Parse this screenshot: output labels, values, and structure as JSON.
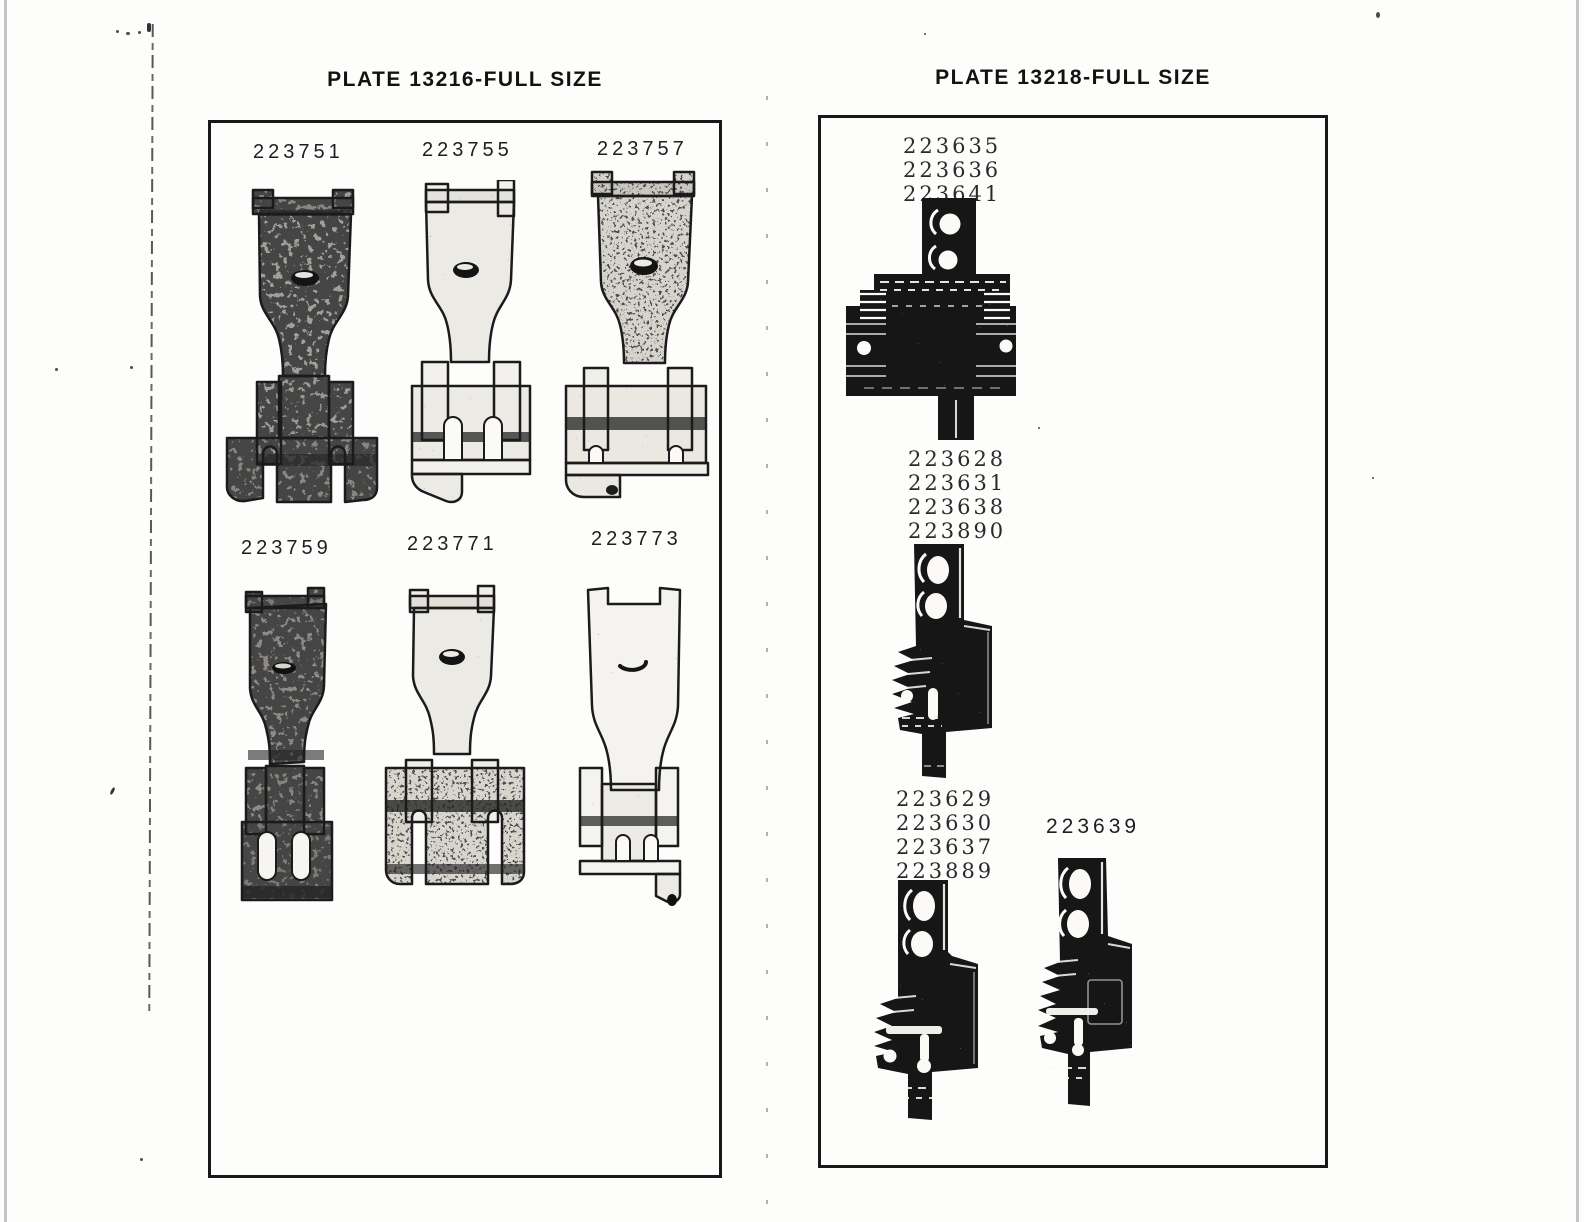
{
  "document": {
    "plates": [
      {
        "title": "PLATE 13216-FULL SIZE",
        "parts": [
          {
            "labels": [
              "223751"
            ]
          },
          {
            "labels": [
              "223755"
            ]
          },
          {
            "labels": [
              "223757"
            ]
          },
          {
            "labels": [
              "223759"
            ]
          },
          {
            "labels": [
              "223771"
            ]
          },
          {
            "labels": [
              "223773"
            ]
          }
        ]
      },
      {
        "title": "PLATE 13218-FULL SIZE",
        "parts": [
          {
            "labels": [
              "223635",
              "223636",
              "223641"
            ]
          },
          {
            "labels": [
              "223628",
              "223631",
              "223638",
              "223890"
            ]
          },
          {
            "labels": [
              "223629",
              "223630",
              "223637",
              "223889"
            ]
          },
          {
            "labels": [
              "223639"
            ]
          }
        ]
      }
    ]
  }
}
